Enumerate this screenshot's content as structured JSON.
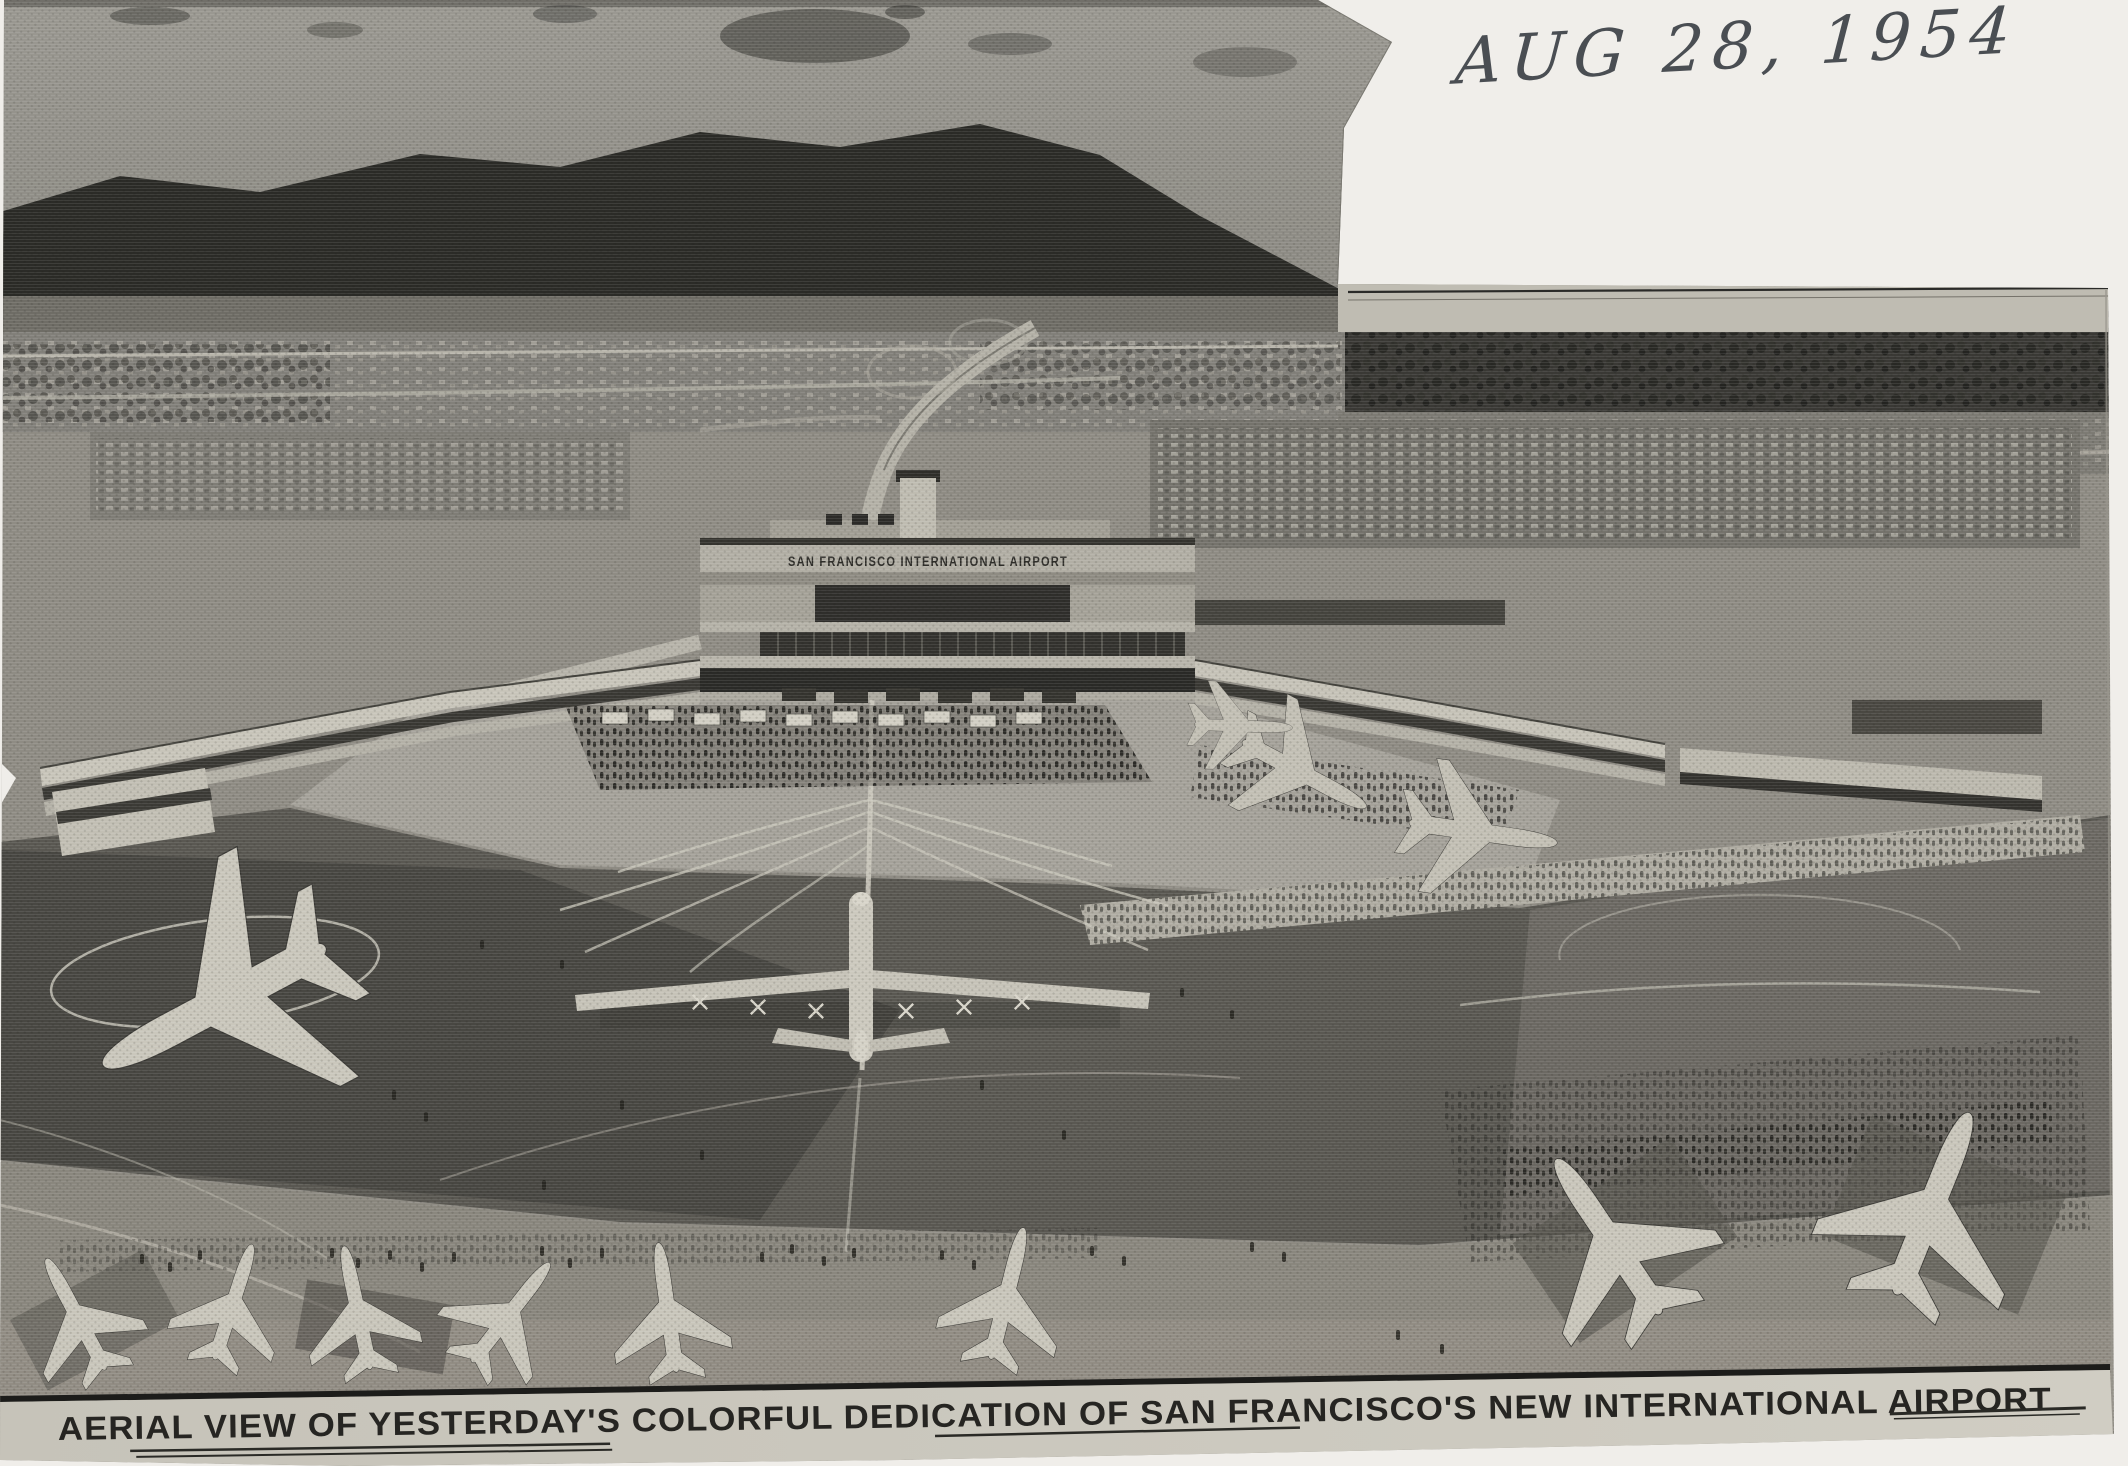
{
  "annotation": {
    "handwritten_date": "AUG 28, 1954",
    "pencil_color": "#4a4e53"
  },
  "caption": {
    "text": "AERIAL VIEW OF YESTERDAY'S COLORFUL DEDICATION OF SAN FRANCISCO'S NEW INTERNATIONAL AIRPORT"
  },
  "photo": {
    "terminal_sign": "SAN FRANCISCO INTERNATIONAL AIRPORT"
  },
  "palette": {
    "scan_paper": "#f0eeea",
    "newsprint_strip": "#c9c6bc",
    "caption_ink": "#262522",
    "photo_dark": "#2b2b27",
    "photo_light": "#c8c5ba"
  }
}
